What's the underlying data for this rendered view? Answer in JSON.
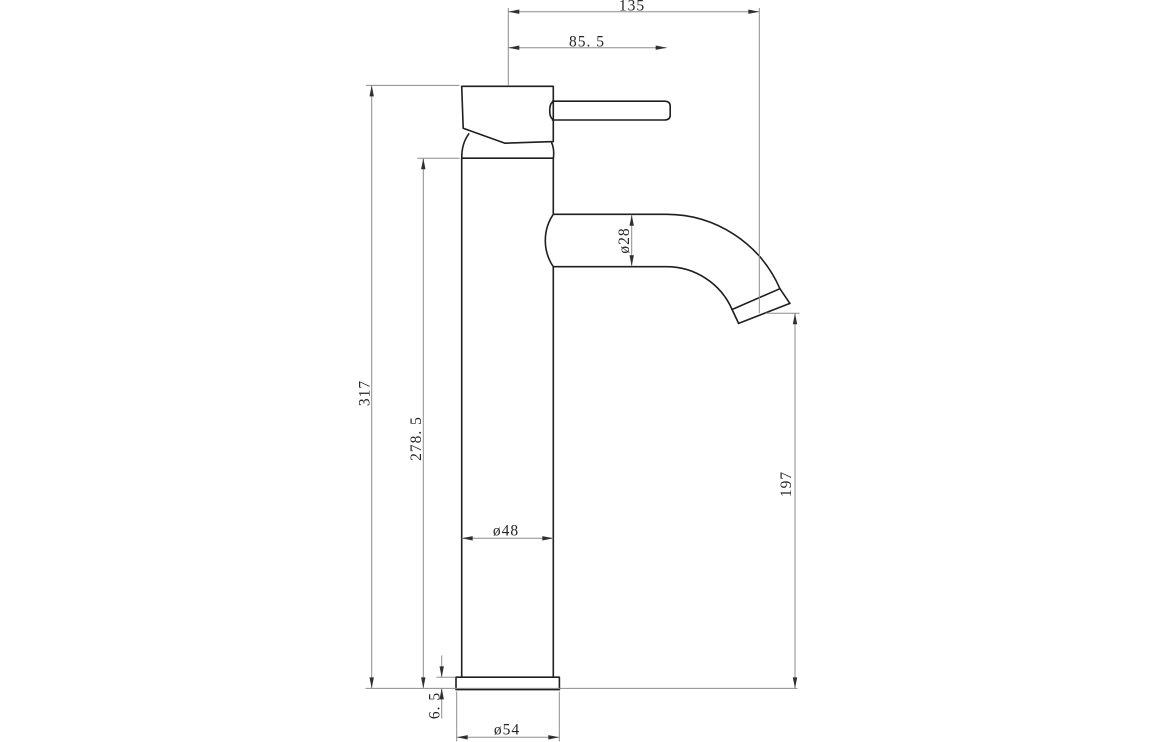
{
  "drawing": {
    "dimensions": {
      "overall_width": "135",
      "handle_projection": "85. 5",
      "overall_height": "317",
      "body_height": "278. 5",
      "spout_diameter": "ø28",
      "spout_outlet_height": "197",
      "body_diameter": "ø48",
      "base_plate_height": "6. 5",
      "base_diameter": "ø54"
    },
    "colors": {
      "outline": "#1f1f1f",
      "dimline": "#8d8d8d",
      "arrow": "#303030",
      "labeltext": "#262626",
      "background": "#ffffff"
    }
  }
}
